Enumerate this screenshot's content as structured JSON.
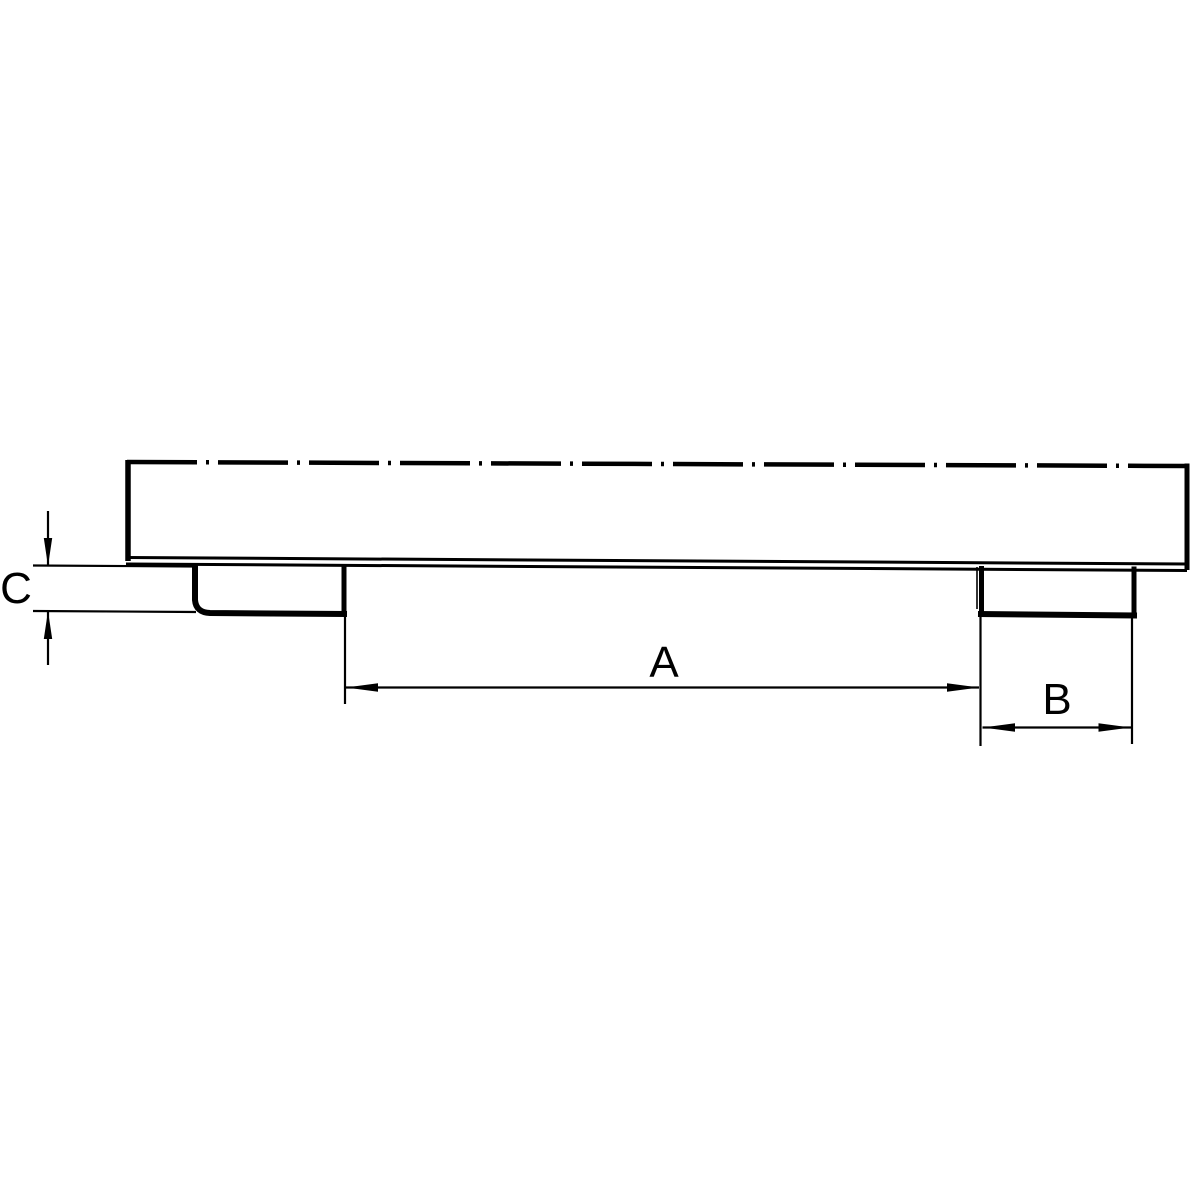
{
  "canvas": {
    "background_color": "#ffffff",
    "line_color": "#000000"
  },
  "dimensions": {
    "a": {
      "label": "A"
    },
    "b": {
      "label": "B"
    },
    "c": {
      "label": "C"
    }
  }
}
